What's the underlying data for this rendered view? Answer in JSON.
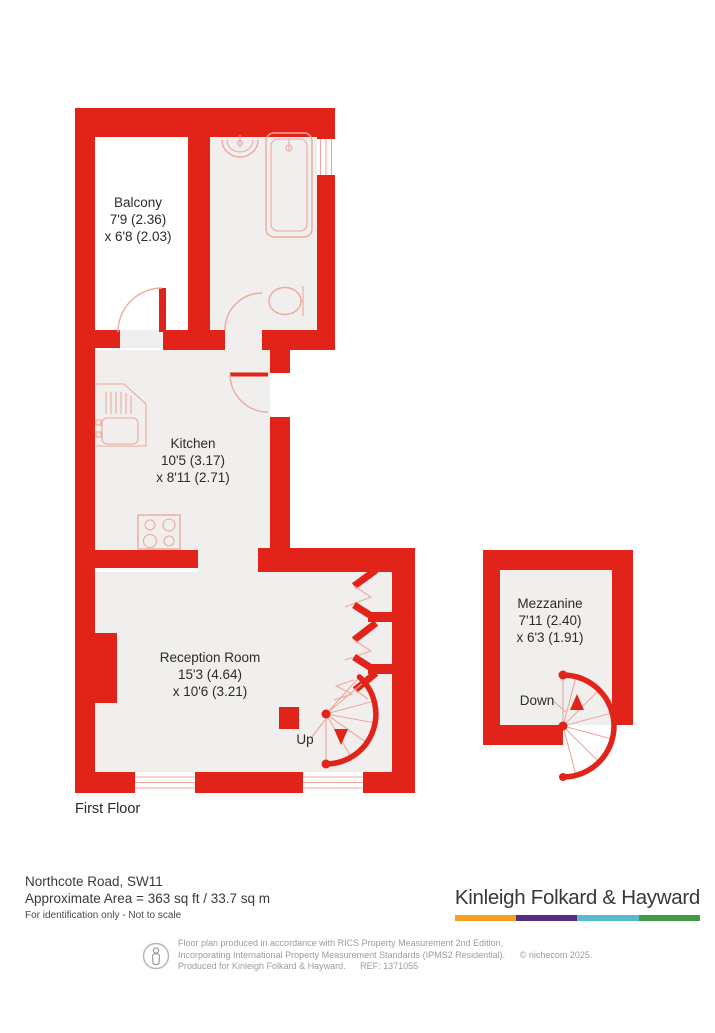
{
  "plan": {
    "floor_label": "First Floor",
    "rooms": {
      "balcony": {
        "name": "Balcony",
        "dim1": "7'9 (2.36)",
        "dim2": "x 6'8 (2.03)"
      },
      "kitchen": {
        "name": "Kitchen",
        "dim1": "10'5 (3.17)",
        "dim2": "x 8'11 (2.71)"
      },
      "reception": {
        "name": "Reception Room",
        "dim1": "15'3 (4.64)",
        "dim2": "x 10'6 (3.21)"
      },
      "mezzanine": {
        "name": "Mezzanine",
        "dim1": "7'11 (2.40)",
        "dim2": "x 6'3 (1.91)"
      }
    },
    "stairs": {
      "up_label": "Up",
      "down_label": "Down"
    },
    "colors": {
      "wall": "#e2231a",
      "room": "#f0efed",
      "fixture": "#eda89f",
      "balcony": "#ffffff",
      "label": "#2e2b27"
    }
  },
  "footer": {
    "address": "Northcote Road, SW11",
    "area": "Approximate Area = 363 sq ft / 33.7 sq m",
    "note": "For identification only - Not to scale",
    "brand": {
      "name": "Kinleigh Folkard & Hayward",
      "bar_colors": [
        "#f5a01e",
        "#572d82",
        "#57bcc9",
        "#459a47"
      ]
    },
    "disclaimer": {
      "line1": "Floor plan produced in accordance with RICS Property Measurement 2nd Edition,",
      "line2": "Incorporating International Property Measurement Standards (IPMS2 Residential).",
      "copyright": "© nichecom 2025.",
      "line3": "Produced for Kinleigh Folkard & Hayward.",
      "ref": "REF: 1371055"
    }
  }
}
